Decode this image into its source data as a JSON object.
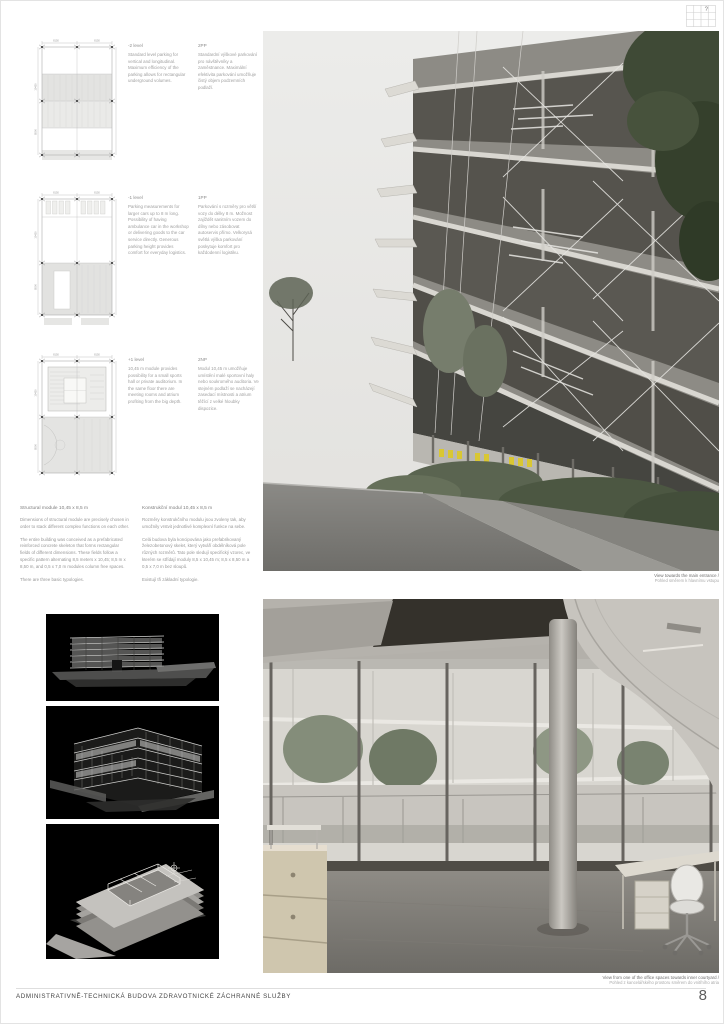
{
  "page": {
    "number": "8",
    "title": "ADMINISTRATIVNĚ-TECHNICKÁ BUDOVA ZDRAVOTNICKÉ ZÁCHRANNÉ SLUŽBY"
  },
  "locator": {
    "marker": "?"
  },
  "plans": [
    {
      "dims_top": [
        "8150",
        "8150"
      ],
      "dims_left": [
        "10450",
        "8500"
      ],
      "caption_en": {
        "heading": "-2 level",
        "body": "Standard level parking for vertical and longitudinal. Maximum efficiency of the parking allows for rectangular underground volumes."
      },
      "caption_cz": {
        "heading": "2PP",
        "body": "Standardní výškové parkování pro návštěvníky a zaměstnance. Maximální efektivita parkování umožňuje čistý objem podzemních podlaží."
      }
    },
    {
      "dims_top": [
        "8150",
        "8150"
      ],
      "dims_left": [
        "10450",
        "8500"
      ],
      "caption_en": {
        "heading": "-1 level",
        "body": "Parking measurements for larger cars up to 8 m long. Possibility of having ambulance car in the workshop or delivering goods to the car service directly. Generous parking height provides comfort for everyday logistics."
      },
      "caption_cz": {
        "heading": "1PP",
        "body": "Parkování s rozměry pro větší vozy do délky 8 m. Možnost zajíždět sanitním vozem do dílny nebo zásobovat autoservis přímo. Velkorysá světlá výška parkování poskytuje komfort pro každodenní logistiku."
      }
    },
    {
      "dims_top": [
        "8150",
        "8150"
      ],
      "dims_left": [
        "10450",
        "8500"
      ],
      "caption_en": {
        "heading": "+1 level",
        "body": "10,45 m module provides possibility for a small sports hall or private auditorium. In the same floor there are meeting rooms and atrium profiting from the big depth."
      },
      "caption_cz": {
        "heading": "2NP",
        "body": "Modul 10,45 m umožňuje umístění malé sportovní haly nebo soukromého auditoria. Ve stejném podlaží se nacházejí zasedací místnosti a atrium těžící z velké hloubky dispozice."
      }
    }
  ],
  "text_block": {
    "en": {
      "heading": "Structural module 10,45 x 8,5 m",
      "paragraphs": [
        "Dimensions of structural module are precisely chosen in order to stack different complex functions on each other.",
        "The entire building was conceived as a prefabricated reinforced concrete skeleton that forms rectangular fields of different dimensions. These fields follow a specific pattern alternating 8,5 meters x 10,45; 8,5 m x 8,50 m, and 0,5 x 7,0 m modules column free spaces.",
        "There are three basic typologies."
      ]
    },
    "cz": {
      "heading": "Konstrukční modul 10,45 x 8,5 m",
      "paragraphs": [
        "Rozměry konstrukčního modulu jsou zvoleny tak, aby umožnily vrstvit jednotlivé komplexní funkce na sebe.",
        "Celá budova byla koncipována jako prefabrikovaný železobetonový skelet, který vytváří obdélníková pole různých rozměrů. Tato pole sledují specifický vzorec, ve kterém se střídají moduly 8,5 x 10,45 m; 8,5 x 8,50 m a 0,5 x 7,0 m bez sloupů.",
        "Existují tři základní typologie."
      ]
    }
  },
  "renders": {
    "exterior": {
      "caption_en": "View towards the main entrance /",
      "caption_cz": "Pohled směrem k hlavnímu vstupu"
    },
    "interior": {
      "caption_en": "View from one of the office spaces towards inner courtyard /",
      "caption_cz": "Pohled z kancelářského prostoru směrem do vnitřního atria"
    }
  },
  "accent_colors": {
    "chair_yellow": "#d9c733",
    "foliage_green": "#3f4a36",
    "plan_fill": "#e4e4e2"
  }
}
